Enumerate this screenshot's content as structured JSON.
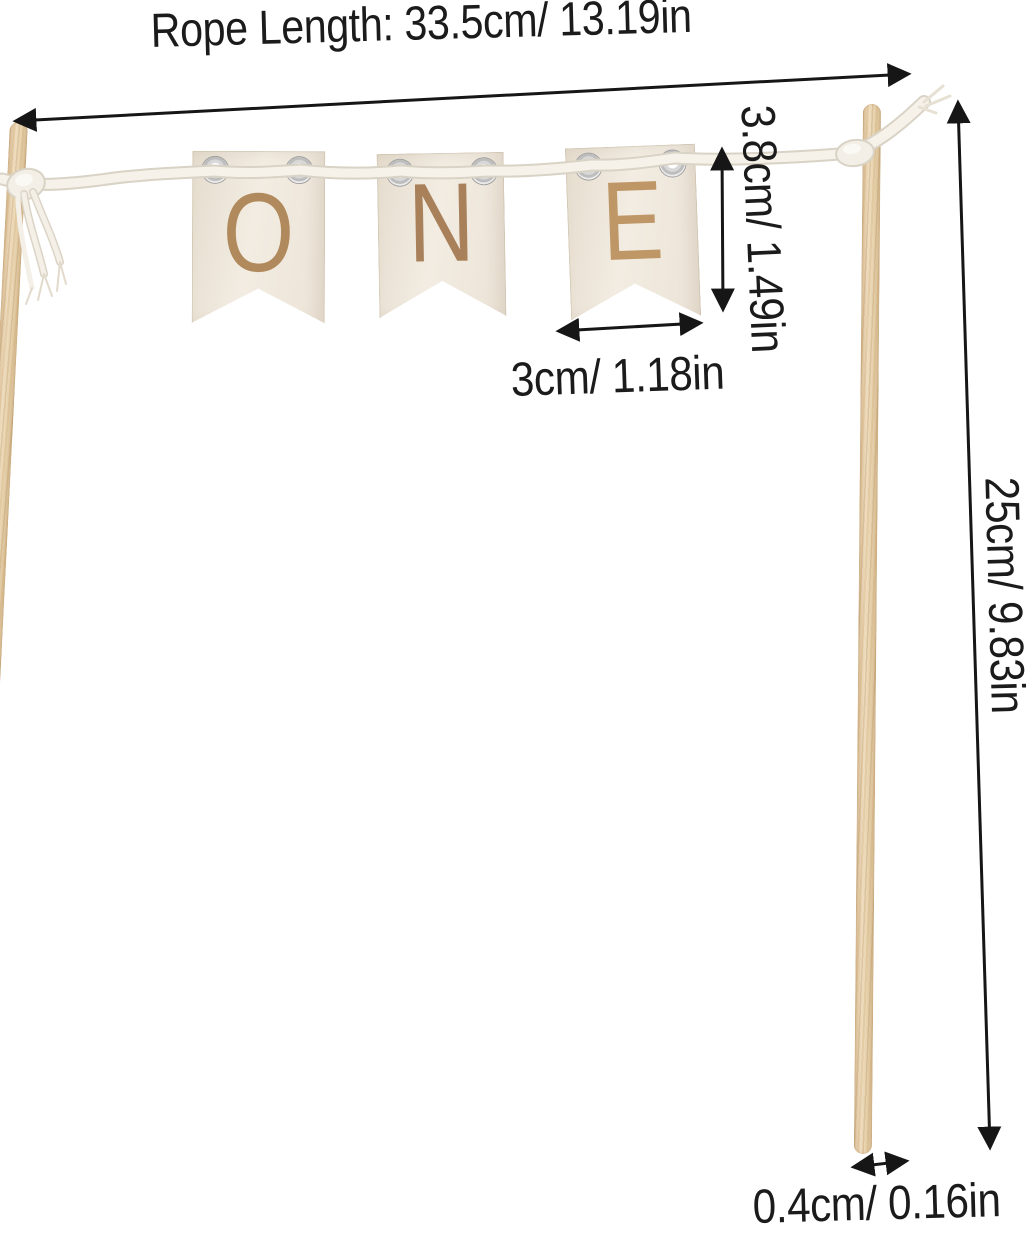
{
  "banner": {
    "letters": [
      "O",
      "N",
      "E"
    ],
    "letter_colors": [
      "#b08a5c",
      "#a8805a",
      "#bf9766"
    ]
  },
  "dimensions": {
    "rope_length": "Rope Length: 33.5cm/ 13.19in",
    "flag_height": "3.8cm/ 1.49in",
    "flag_width": "3cm/ 1.18in",
    "stick_length": "25cm/ 9.83in",
    "stick_diameter": "0.4cm/ 0.16in"
  },
  "colors": {
    "background": "#ffffff",
    "annotation_ink": "#1b1b1b",
    "flag_wood": "#efe8dc",
    "stick_wood": "#e8d4b2",
    "rope": "#f6f2ea",
    "rope_shadow": "#d9d3c6",
    "eyelet_metal": "#c9c9c9"
  }
}
